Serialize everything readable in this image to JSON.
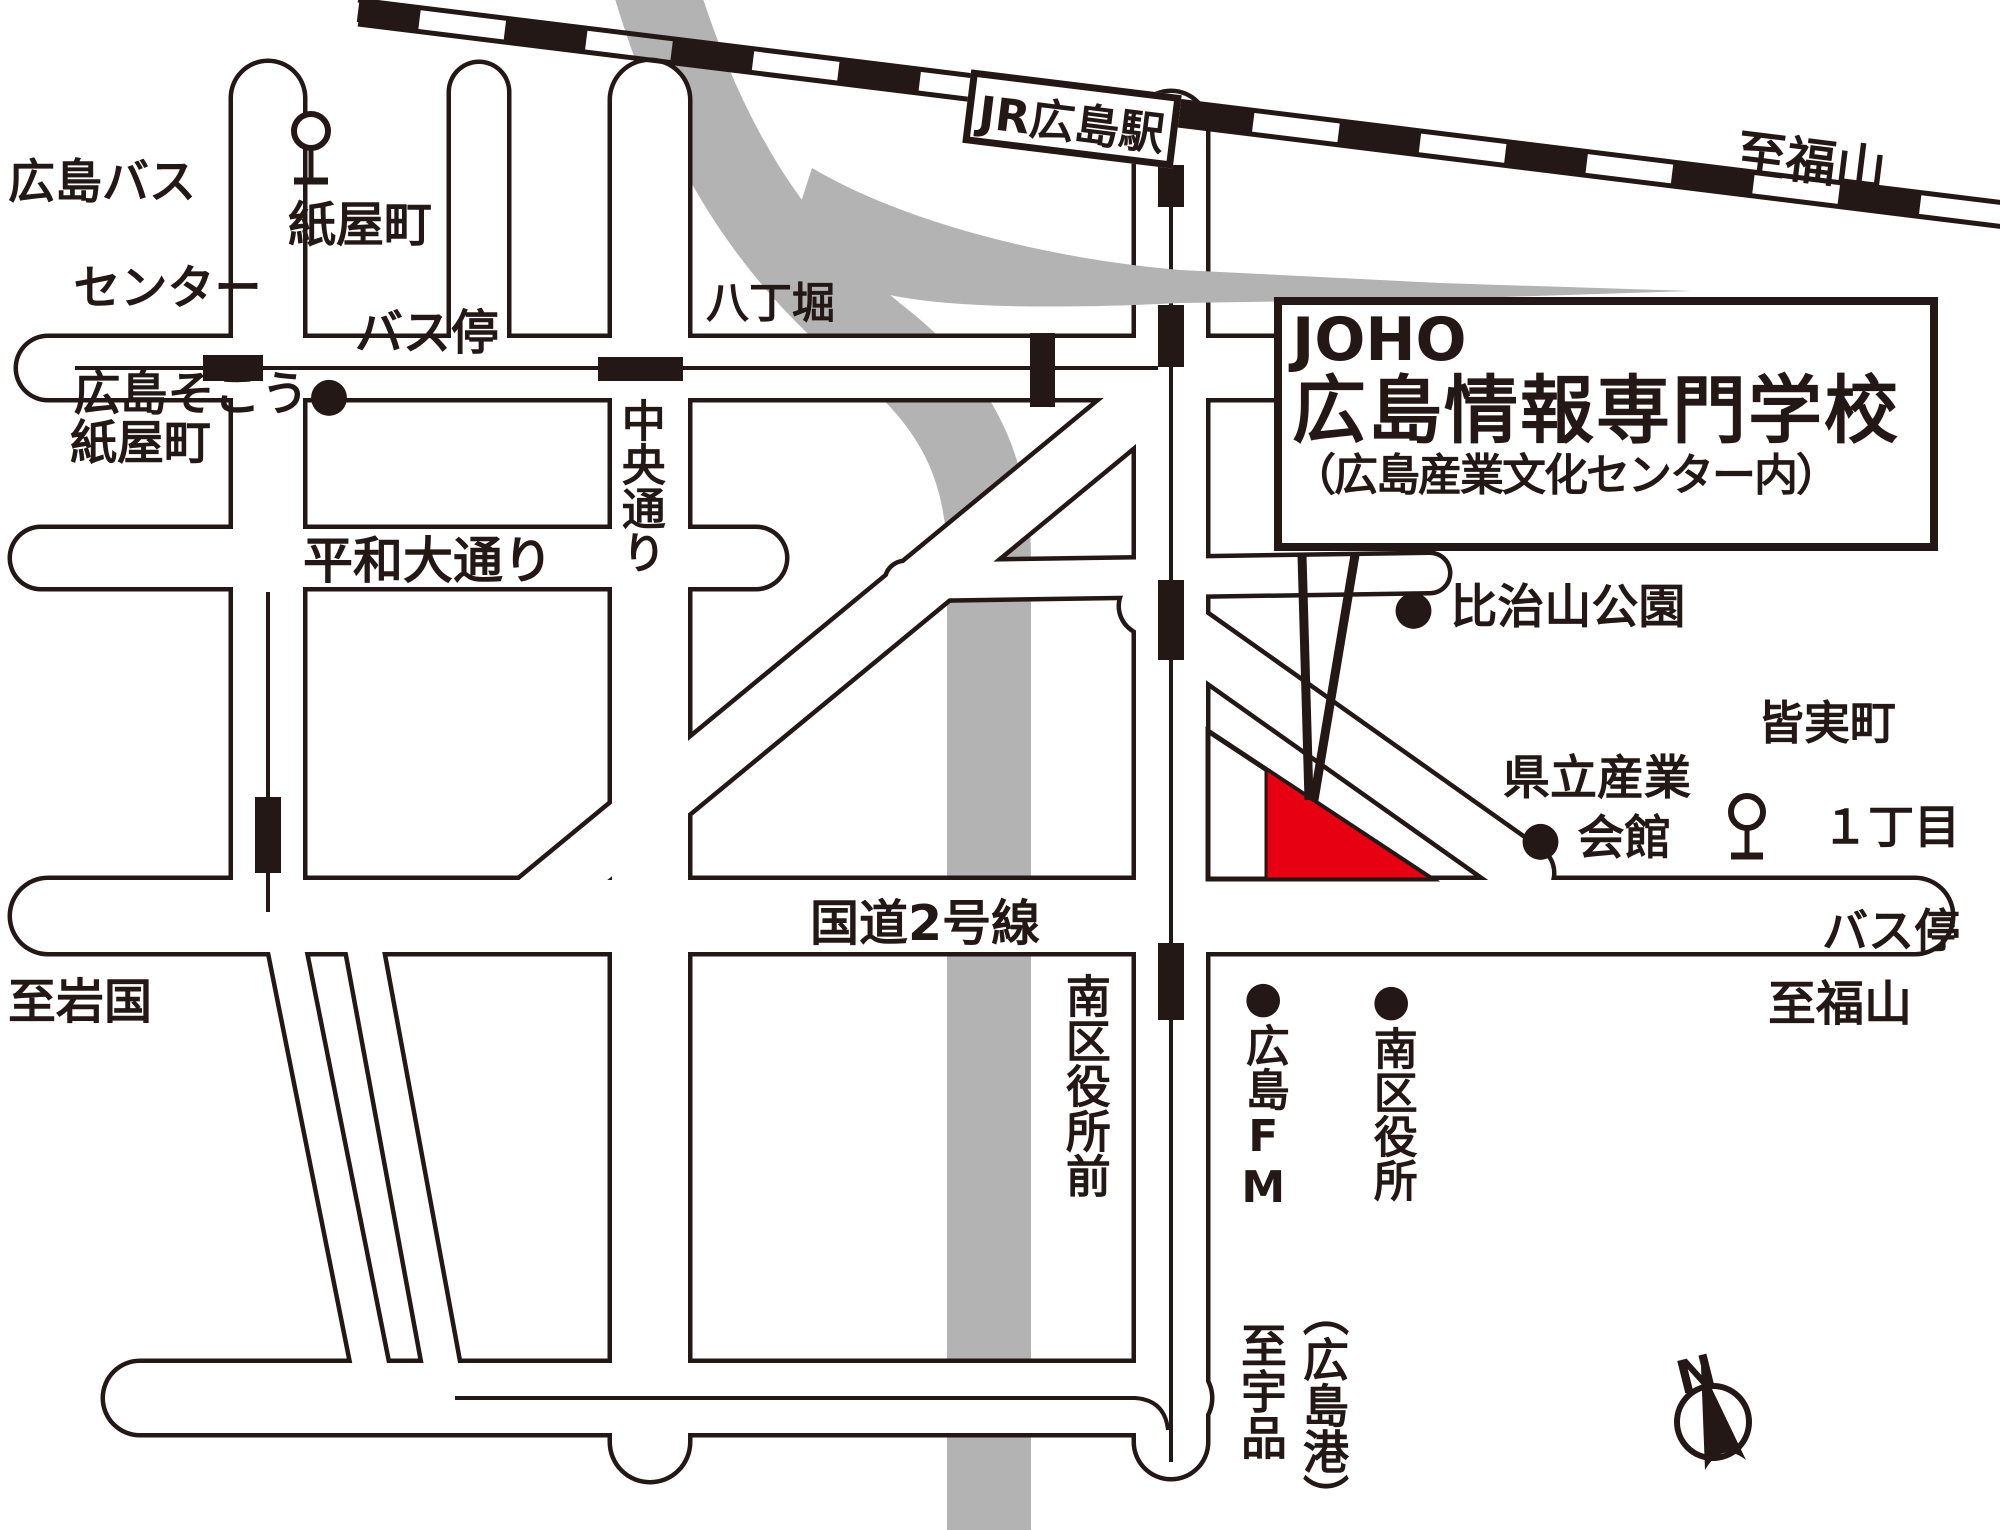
{
  "colors": {
    "ink": "#231815",
    "red": "#e60012",
    "gray": "#b3b3b3",
    "bg": "#ffffff"
  },
  "station": {
    "label": "JR広島駅"
  },
  "school_box": {
    "line1": "JOHO",
    "line2": "広島情報専門学校",
    "line3": "（広島産業文化センター内）"
  },
  "labels": {
    "bus_center": [
      "広島バス",
      "センター",
      "広島そごう●"
    ],
    "kamiyacho_busstop": [
      "紙屋町",
      "バス停"
    ],
    "hatchobori": "八丁堀",
    "kamiyacho": "紙屋町",
    "chuo_dori": "中央通り",
    "heiwa_odori": "平和大通り",
    "to_fukuyama_rail": "至福山",
    "hijiyama_park": "● 比治山公園",
    "kenritsu_sangyo": "県立産業",
    "kaikan": "● 会館",
    "minami_1chome": [
      "皆実町",
      "１丁目",
      "バス停"
    ],
    "kokudo2": "国道2号線",
    "to_iwakuni": "至岩国",
    "to_fukuyama_road": "至福山",
    "minamiku_yakusho_mae": "南区役所前",
    "hiroshima_fm": "●広島FM",
    "minamiku_yakusho": "●南区役所",
    "to_ujina": "至宇品",
    "hiroshima_port": "（広島港）",
    "compass_north": "N"
  }
}
